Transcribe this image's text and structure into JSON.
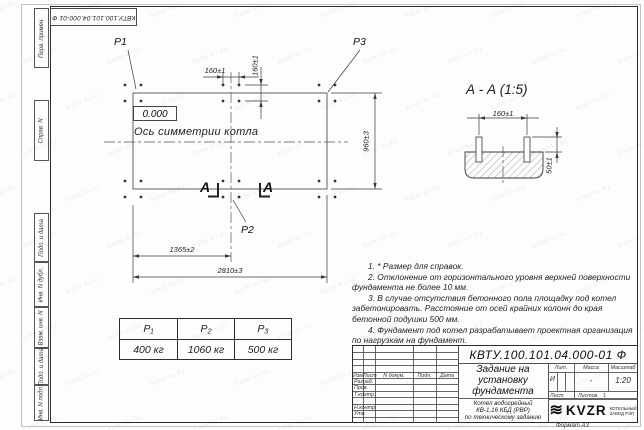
{
  "corner_stamp": "КВТУ.100.101.04.000-01  Ф",
  "sidebar": {
    "labels": [
      "Перв. примен.",
      "Справ. N",
      "Подп. и дата",
      "Инв. N дубл.",
      "Взам. инв. N",
      "Подп. и дата",
      "Инв. N подл."
    ]
  },
  "plan": {
    "point_labels": {
      "p1": "P1",
      "p2": "P2",
      "p3": "P3"
    },
    "level_mark": "0.000",
    "axis_label": "Ось симметрии котла",
    "dim_bolt_h": "160±1",
    "dim_bolt_v": "160±1",
    "dim_width": "960±3",
    "dim_half_length": "1365±2",
    "dim_length": "2810±3",
    "cut_letter_left": "А",
    "cut_letter_right": "А"
  },
  "section": {
    "title": "А - А (1:5)",
    "dim_bolts": "160±1",
    "dim_height": "50±1"
  },
  "notes": [
    "1. * Размер для справок.",
    "2. Отклонение от горизонтального уровня верхней поверхности фундамента не более 10 мм.",
    "3. В случае отсутствия бетонного пола площадку под котел забетонировать. Расстояние от осей крайних колонн до края бетонной подушки 500 мм.",
    "4. Фундамент под котел разрабатывает проектная организация по нагрузкам на фундамент."
  ],
  "load_table": {
    "headers": [
      "P₁",
      "P₂",
      "P₃"
    ],
    "values": [
      "400 кг",
      "1060 кг",
      "500 кг"
    ]
  },
  "title_block": {
    "designation": "КВТУ.100.101.04.000-01  Ф",
    "doc_title": [
      "Задание на",
      "установку",
      "фундамента"
    ],
    "product": [
      "Котел водогрейный",
      "КВ-1,16  КБД  (РВР)",
      "по техническому заданию"
    ],
    "header_cols": [
      "Изм.",
      "Лист",
      "N докум.",
      "Подп.",
      "Дата"
    ],
    "sign_rows": [
      "Разраб.",
      "Пров.",
      "Т.контр.",
      "Н.контр.",
      "Утв."
    ],
    "lit_label": "Лит.",
    "mass_label": "Масса",
    "scale_label": "Масштаб",
    "lit_value": "И",
    "mass_value": "-",
    "scale_value": "1:20",
    "sheet_label": "Лист",
    "sheets_label": "Листов",
    "sheets_count": "1",
    "logo_mark": "≋",
    "logo_text": "KVZR",
    "logo_sub": [
      "КОТЕЛЬНЫЙ",
      "ЗАВОД РЭП"
    ],
    "format_note": "Формат А3"
  },
  "watermark": "kotel-kv.kz",
  "colors": {
    "line": "#3a3a3a",
    "text": "#1e1e1e",
    "background": "#fdfdfd"
  }
}
